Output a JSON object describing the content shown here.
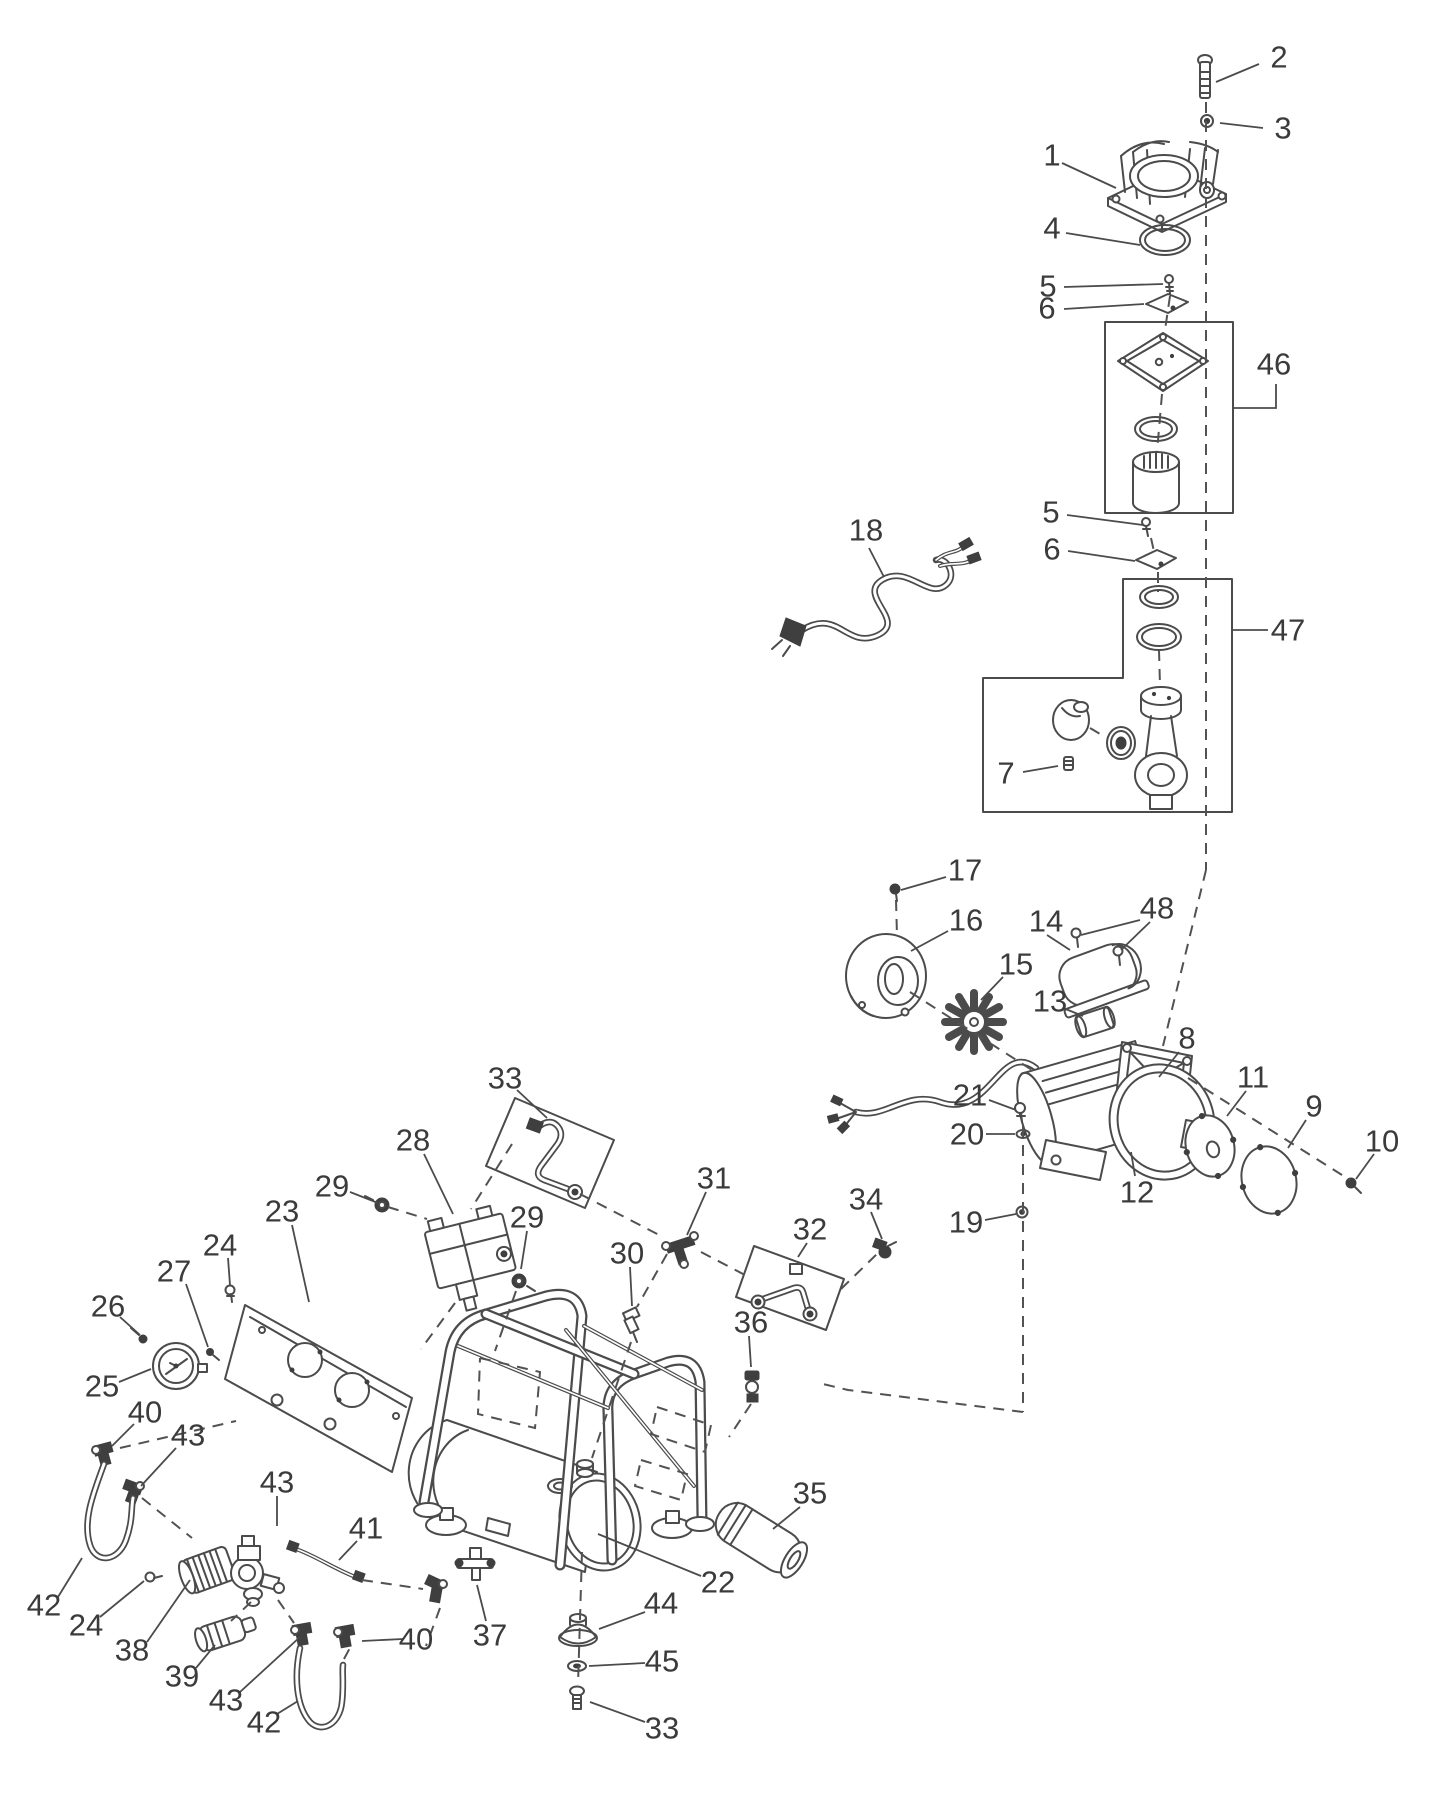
{
  "figure": {
    "kind": "exploded-parts-diagram",
    "subject": "portable air compressor exploded view",
    "background_color": "#ffffff",
    "line_color": "#4b4b4b",
    "label_color": "#3b3b3b",
    "label_font_size": 31
  },
  "callouts": [
    {
      "id": "1",
      "label": "1",
      "x": 1052,
      "y": 155,
      "leaders": [
        [
          [
            1062,
            163
          ],
          [
            1116,
            188
          ]
        ]
      ]
    },
    {
      "id": "2",
      "label": "2",
      "x": 1279,
      "y": 57,
      "leaders": [
        [
          [
            1259,
            64
          ],
          [
            1216,
            82
          ]
        ]
      ]
    },
    {
      "id": "3",
      "label": "3",
      "x": 1283,
      "y": 128,
      "leaders": [
        [
          [
            1263,
            128
          ],
          [
            1220,
            123
          ]
        ]
      ]
    },
    {
      "id": "4",
      "label": "4",
      "x": 1052,
      "y": 228,
      "leaders": [
        [
          [
            1066,
            233
          ],
          [
            1140,
            245
          ]
        ]
      ]
    },
    {
      "id": "5a",
      "label": "5",
      "x": 1048,
      "y": 286,
      "leaders": [
        [
          [
            1064,
            287
          ],
          [
            1163,
            284
          ]
        ]
      ]
    },
    {
      "id": "6a",
      "label": "6",
      "x": 1047,
      "y": 308,
      "leaders": [
        [
          [
            1064,
            309
          ],
          [
            1144,
            304
          ]
        ]
      ]
    },
    {
      "id": "46",
      "label": "46",
      "x": 1274,
      "y": 364,
      "leaders": [
        [
          [
            1233,
            408
          ],
          [
            1276,
            408
          ],
          [
            1276,
            384
          ]
        ]
      ]
    },
    {
      "id": "5b",
      "label": "5",
      "x": 1051,
      "y": 512,
      "leaders": [
        [
          [
            1067,
            515
          ],
          [
            1143,
            525
          ]
        ]
      ]
    },
    {
      "id": "6b",
      "label": "6",
      "x": 1052,
      "y": 549,
      "leaders": [
        [
          [
            1068,
            551
          ],
          [
            1135,
            561
          ]
        ]
      ]
    },
    {
      "id": "47",
      "label": "47",
      "x": 1288,
      "y": 630,
      "leaders": [
        [
          [
            1268,
            630
          ],
          [
            1233,
            630
          ]
        ]
      ]
    },
    {
      "id": "18",
      "label": "18",
      "x": 866,
      "y": 530,
      "leaders": [
        [
          [
            869,
            548
          ],
          [
            884,
            577
          ]
        ]
      ]
    },
    {
      "id": "7",
      "label": "7",
      "x": 1006,
      "y": 773,
      "leaders": [
        [
          [
            1023,
            772
          ],
          [
            1058,
            766
          ]
        ]
      ]
    },
    {
      "id": "17",
      "label": "17",
      "x": 965,
      "y": 870,
      "leaders": [
        [
          [
            946,
            877
          ],
          [
            901,
            890
          ]
        ]
      ]
    },
    {
      "id": "16",
      "label": "16",
      "x": 966,
      "y": 920,
      "leaders": [
        [
          [
            948,
            931
          ],
          [
            911,
            951
          ]
        ]
      ]
    },
    {
      "id": "15",
      "label": "15",
      "x": 1016,
      "y": 964,
      "leaders": [
        [
          [
            1003,
            977
          ],
          [
            981,
            1000
          ]
        ]
      ]
    },
    {
      "id": "14",
      "label": "14",
      "x": 1046,
      "y": 921,
      "leaders": [
        [
          [
            1047,
            935
          ],
          [
            1070,
            950
          ]
        ]
      ]
    },
    {
      "id": "48",
      "label": "48",
      "x": 1157,
      "y": 908,
      "leaders": [
        [
          [
            1140,
            920
          ],
          [
            1081,
            935
          ]
        ],
        [
          [
            1150,
            922
          ],
          [
            1121,
            950
          ]
        ]
      ]
    },
    {
      "id": "13",
      "label": "13",
      "x": 1050,
      "y": 1001,
      "leaders": [
        [
          [
            1063,
            1008
          ],
          [
            1083,
            1016
          ]
        ]
      ]
    },
    {
      "id": "8",
      "label": "8",
      "x": 1187,
      "y": 1038,
      "leaders": [
        [
          [
            1179,
            1052
          ],
          [
            1159,
            1077
          ]
        ]
      ]
    },
    {
      "id": "21",
      "label": "21",
      "x": 970,
      "y": 1095,
      "leaders": [
        [
          [
            989,
            1100
          ],
          [
            1016,
            1110
          ]
        ]
      ]
    },
    {
      "id": "20",
      "label": "20",
      "x": 967,
      "y": 1134,
      "leaders": [
        [
          [
            986,
            1134
          ],
          [
            1015,
            1134
          ]
        ]
      ]
    },
    {
      "id": "19",
      "label": "19",
      "x": 966,
      "y": 1222,
      "leaders": [
        [
          [
            985,
            1220
          ],
          [
            1016,
            1214
          ]
        ]
      ]
    },
    {
      "id": "12",
      "label": "12",
      "x": 1137,
      "y": 1192,
      "leaders": [
        [
          [
            1135,
            1176
          ],
          [
            1131,
            1152
          ]
        ]
      ]
    },
    {
      "id": "11",
      "label": "11",
      "x": 1253,
      "y": 1077,
      "leaders": [
        [
          [
            1246,
            1091
          ],
          [
            1227,
            1116
          ]
        ]
      ]
    },
    {
      "id": "9",
      "label": "9",
      "x": 1314,
      "y": 1106,
      "leaders": [
        [
          [
            1306,
            1120
          ],
          [
            1288,
            1148
          ]
        ]
      ]
    },
    {
      "id": "10",
      "label": "10",
      "x": 1382,
      "y": 1141,
      "leaders": [
        [
          [
            1374,
            1154
          ],
          [
            1356,
            1179
          ]
        ]
      ]
    },
    {
      "id": "33a",
      "label": "33",
      "x": 505,
      "y": 1078,
      "leaders": [
        [
          [
            517,
            1090
          ],
          [
            547,
            1118
          ]
        ]
      ]
    },
    {
      "id": "28",
      "label": "28",
      "x": 413,
      "y": 1140,
      "leaders": [
        [
          [
            424,
            1154
          ],
          [
            453,
            1214
          ]
        ]
      ]
    },
    {
      "id": "29a",
      "label": "29",
      "x": 332,
      "y": 1186,
      "leaders": [
        [
          [
            350,
            1192
          ],
          [
            378,
            1203
          ]
        ]
      ]
    },
    {
      "id": "29b",
      "label": "29",
      "x": 527,
      "y": 1217,
      "leaders": [
        [
          [
            527,
            1231
          ],
          [
            521,
            1269
          ]
        ]
      ]
    },
    {
      "id": "31",
      "label": "31",
      "x": 714,
      "y": 1178,
      "leaders": [
        [
          [
            706,
            1192
          ],
          [
            687,
            1235
          ]
        ]
      ]
    },
    {
      "id": "30",
      "label": "30",
      "x": 627,
      "y": 1253,
      "leaders": [
        [
          [
            630,
            1267
          ],
          [
            632,
            1306
          ]
        ]
      ]
    },
    {
      "id": "32",
      "label": "32",
      "x": 810,
      "y": 1229,
      "leaders": [
        [
          [
            807,
            1243
          ],
          [
            798,
            1257
          ]
        ]
      ]
    },
    {
      "id": "34",
      "label": "34",
      "x": 866,
      "y": 1199,
      "leaders": [
        [
          [
            871,
            1212
          ],
          [
            882,
            1239
          ]
        ]
      ]
    },
    {
      "id": "36",
      "label": "36",
      "x": 751,
      "y": 1322,
      "leaders": [
        [
          [
            749,
            1336
          ],
          [
            751,
            1367
          ]
        ]
      ]
    },
    {
      "id": "23",
      "label": "23",
      "x": 282,
      "y": 1211,
      "leaders": [
        [
          [
            292,
            1225
          ],
          [
            309,
            1302
          ]
        ]
      ]
    },
    {
      "id": "24a",
      "label": "24",
      "x": 220,
      "y": 1245,
      "leaders": [
        [
          [
            228,
            1258
          ],
          [
            230,
            1285
          ]
        ]
      ]
    },
    {
      "id": "27",
      "label": "27",
      "x": 174,
      "y": 1271,
      "leaders": [
        [
          [
            186,
            1284
          ],
          [
            208,
            1347
          ]
        ]
      ]
    },
    {
      "id": "26",
      "label": "26",
      "x": 108,
      "y": 1306,
      "leaders": [
        [
          [
            120,
            1317
          ],
          [
            140,
            1335
          ]
        ]
      ]
    },
    {
      "id": "25",
      "label": "25",
      "x": 102,
      "y": 1386,
      "leaders": [
        [
          [
            119,
            1382
          ],
          [
            151,
            1369
          ]
        ]
      ]
    },
    {
      "id": "40a",
      "label": "40",
      "x": 145,
      "y": 1412,
      "leaders": [
        [
          [
            134,
            1424
          ],
          [
            112,
            1446
          ]
        ]
      ]
    },
    {
      "id": "43a",
      "label": "43",
      "x": 188,
      "y": 1435,
      "leaders": [
        [
          [
            176,
            1448
          ],
          [
            141,
            1486
          ]
        ]
      ]
    },
    {
      "id": "42a",
      "label": "42",
      "x": 44,
      "y": 1605,
      "leaders": [
        [
          [
            58,
            1597
          ],
          [
            82,
            1558
          ]
        ]
      ]
    },
    {
      "id": "24b",
      "label": "24",
      "x": 86,
      "y": 1625,
      "leaders": [
        [
          [
            100,
            1617
          ],
          [
            144,
            1581
          ]
        ]
      ]
    },
    {
      "id": "38",
      "label": "38",
      "x": 132,
      "y": 1650,
      "leaders": [
        [
          [
            147,
            1642
          ],
          [
            190,
            1580
          ]
        ]
      ]
    },
    {
      "id": "39",
      "label": "39",
      "x": 182,
      "y": 1676,
      "leaders": [
        [
          [
            196,
            1668
          ],
          [
            215,
            1645
          ]
        ]
      ]
    },
    {
      "id": "43b",
      "label": "43",
      "x": 277,
      "y": 1482,
      "leaders": [
        [
          [
            277,
            1496
          ],
          [
            277,
            1526
          ]
        ]
      ]
    },
    {
      "id": "41",
      "label": "41",
      "x": 366,
      "y": 1528,
      "leaders": [
        [
          [
            357,
            1541
          ],
          [
            339,
            1560
          ]
        ]
      ]
    },
    {
      "id": "43c",
      "label": "43",
      "x": 226,
      "y": 1700,
      "leaders": [
        [
          [
            240,
            1692
          ],
          [
            300,
            1637
          ]
        ]
      ]
    },
    {
      "id": "42b",
      "label": "42",
      "x": 264,
      "y": 1722,
      "leaders": [
        [
          [
            277,
            1714
          ],
          [
            298,
            1701
          ]
        ]
      ]
    },
    {
      "id": "40b",
      "label": "40",
      "x": 416,
      "y": 1639,
      "leaders": [
        [
          [
            403,
            1639
          ],
          [
            362,
            1641
          ]
        ]
      ]
    },
    {
      "id": "37",
      "label": "37",
      "x": 490,
      "y": 1635,
      "leaders": [
        [
          [
            486,
            1621
          ],
          [
            477,
            1585
          ]
        ]
      ]
    },
    {
      "id": "22",
      "label": "22",
      "x": 718,
      "y": 1582,
      "leaders": [
        [
          [
            701,
            1576
          ],
          [
            598,
            1534
          ]
        ]
      ]
    },
    {
      "id": "44",
      "label": "44",
      "x": 661,
      "y": 1603,
      "leaders": [
        [
          [
            645,
            1612
          ],
          [
            599,
            1629
          ]
        ]
      ]
    },
    {
      "id": "45",
      "label": "45",
      "x": 662,
      "y": 1661,
      "leaders": [
        [
          [
            645,
            1663
          ],
          [
            589,
            1666
          ]
        ]
      ]
    },
    {
      "id": "33b",
      "label": "33",
      "x": 662,
      "y": 1728,
      "leaders": [
        [
          [
            645,
            1722
          ],
          [
            590,
            1702
          ]
        ]
      ]
    },
    {
      "id": "35",
      "label": "35",
      "x": 810,
      "y": 1493,
      "leaders": [
        [
          [
            800,
            1507
          ],
          [
            773,
            1529
          ]
        ]
      ]
    }
  ],
  "dashed_paths": [
    [
      [
        1206,
        102
      ],
      [
        1206,
        870
      ]
    ],
    [
      [
        1206,
        870
      ],
      [
        1163,
        1046
      ]
    ],
    [
      [
        1188,
        1078
      ],
      [
        1350,
        1180
      ]
    ],
    [
      [
        896,
        900
      ],
      [
        897,
        936
      ]
    ],
    [
      [
        910,
        992
      ],
      [
        1032,
        1070
      ]
    ],
    [
      [
        1023,
        1126
      ],
      [
        1023,
        1412
      ]
    ],
    [
      [
        1023,
        1412
      ],
      [
        848,
        1390
      ],
      [
        819,
        1383
      ]
    ],
    [
      [
        388,
        1207
      ],
      [
        427,
        1219
      ]
    ],
    [
      [
        512,
        1144
      ],
      [
        471,
        1209
      ]
    ],
    [
      [
        580,
        1194
      ],
      [
        663,
        1237
      ]
    ],
    [
      [
        701,
        1252
      ],
      [
        745,
        1275
      ]
    ],
    [
      [
        841,
        1289
      ],
      [
        879,
        1252
      ]
    ],
    [
      [
        667,
        1254
      ],
      [
        637,
        1307
      ]
    ],
    [
      [
        631,
        1342
      ],
      [
        592,
        1458
      ]
    ],
    [
      [
        516,
        1291
      ],
      [
        495,
        1351
      ]
    ],
    [
      [
        455,
        1303
      ],
      [
        421,
        1349
      ]
    ],
    [
      [
        480,
        1358
      ],
      [
        540,
        1372
      ],
      [
        535,
        1428
      ],
      [
        478,
        1414
      ],
      [
        480,
        1358
      ]
    ],
    [
      [
        657,
        1407
      ],
      [
        711,
        1425
      ],
      [
        705,
        1452
      ],
      [
        651,
        1434
      ],
      [
        657,
        1407
      ]
    ],
    [
      [
        641,
        1460
      ],
      [
        687,
        1474
      ],
      [
        681,
        1500
      ],
      [
        635,
        1486
      ],
      [
        641,
        1460
      ]
    ],
    [
      [
        751,
        1404
      ],
      [
        729,
        1437
      ]
    ],
    [
      [
        582,
        1552
      ],
      [
        578,
        1685
      ]
    ],
    [
      [
        142,
        1498
      ],
      [
        192,
        1538
      ]
    ],
    [
      [
        120,
        1448
      ],
      [
        236,
        1421
      ]
    ],
    [
      [
        362,
        1580
      ],
      [
        423,
        1589
      ]
    ],
    [
      [
        251,
        1602
      ],
      [
        231,
        1621
      ]
    ],
    [
      [
        278,
        1600
      ],
      [
        294,
        1623
      ]
    ],
    [
      [
        440,
        1608
      ],
      [
        426,
        1646
      ]
    ],
    [
      [
        344,
        1659
      ],
      [
        352,
        1644
      ]
    ],
    [
      [
        1170,
        296
      ],
      [
        1165,
        330
      ]
    ],
    [
      [
        1162,
        394
      ],
      [
        1157,
        452
      ]
    ],
    [
      [
        1151,
        538
      ],
      [
        1155,
        556
      ]
    ],
    [
      [
        1158,
        572
      ],
      [
        1158,
        592
      ]
    ],
    [
      [
        1159,
        650
      ],
      [
        1160,
        686
      ]
    ],
    [
      [
        1090,
        728
      ],
      [
        1105,
        737
      ]
    ]
  ]
}
